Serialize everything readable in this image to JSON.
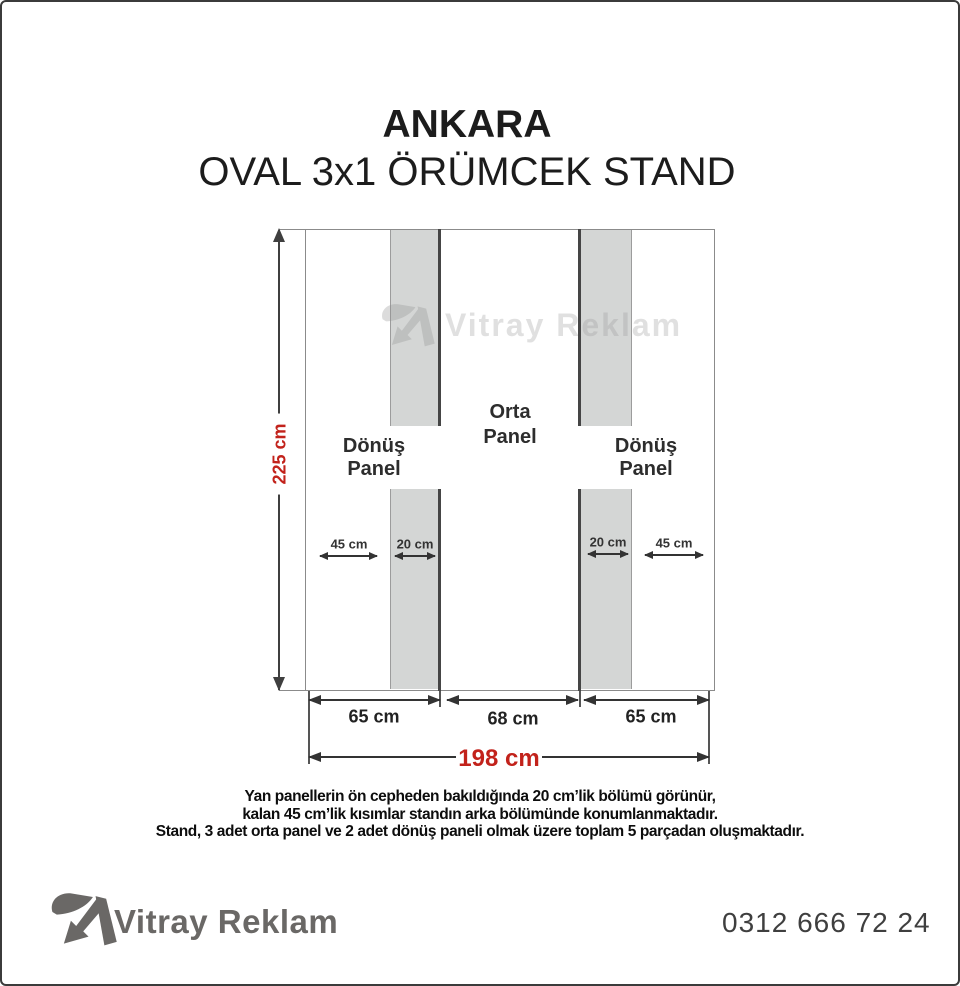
{
  "header": {
    "title": "ANKARA",
    "subtitle": "OVAL 3x1 ÖRÜMCEK STAND"
  },
  "diagram": {
    "total_height": "225 cm",
    "total_width": "198 cm",
    "sections": {
      "left": {
        "label_line1": "Dönüş",
        "label_line2": "Panel",
        "back_dim": "45 cm",
        "front_dim": "20 cm",
        "width_dim": "65 cm"
      },
      "center": {
        "label_line1": "Orta",
        "label_line2": "Panel",
        "width_dim": "68 cm"
      },
      "right": {
        "label_line1": "Dönüş",
        "label_line2": "Panel",
        "front_dim": "20 cm",
        "back_dim": "45 cm",
        "width_dim": "65 cm"
      }
    }
  },
  "watermark": {
    "text": "Vitray Reklam"
  },
  "notes": {
    "line1": "Yan panellerin ön cepheden bakıldığında 20 cm’lik bölümü görünür,",
    "line2": "kalan 45 cm’lik kısımlar standın arka bölümünde konumlanmaktadır.",
    "line3": "Stand, 3 adet orta panel ve 2 adet dönüş paneli olmak üzere toplam 5 parçadan oluşmaktadır."
  },
  "footer": {
    "brand": "Vitray Reklam",
    "phone": "0312 666 72 24"
  },
  "colors": {
    "dimension_red": "#c2221b",
    "panel_gray": "#d4d6d5",
    "line_dark": "#454545",
    "brand_gray": "#6a6866",
    "watermark_gray": "#9a9a9a"
  }
}
